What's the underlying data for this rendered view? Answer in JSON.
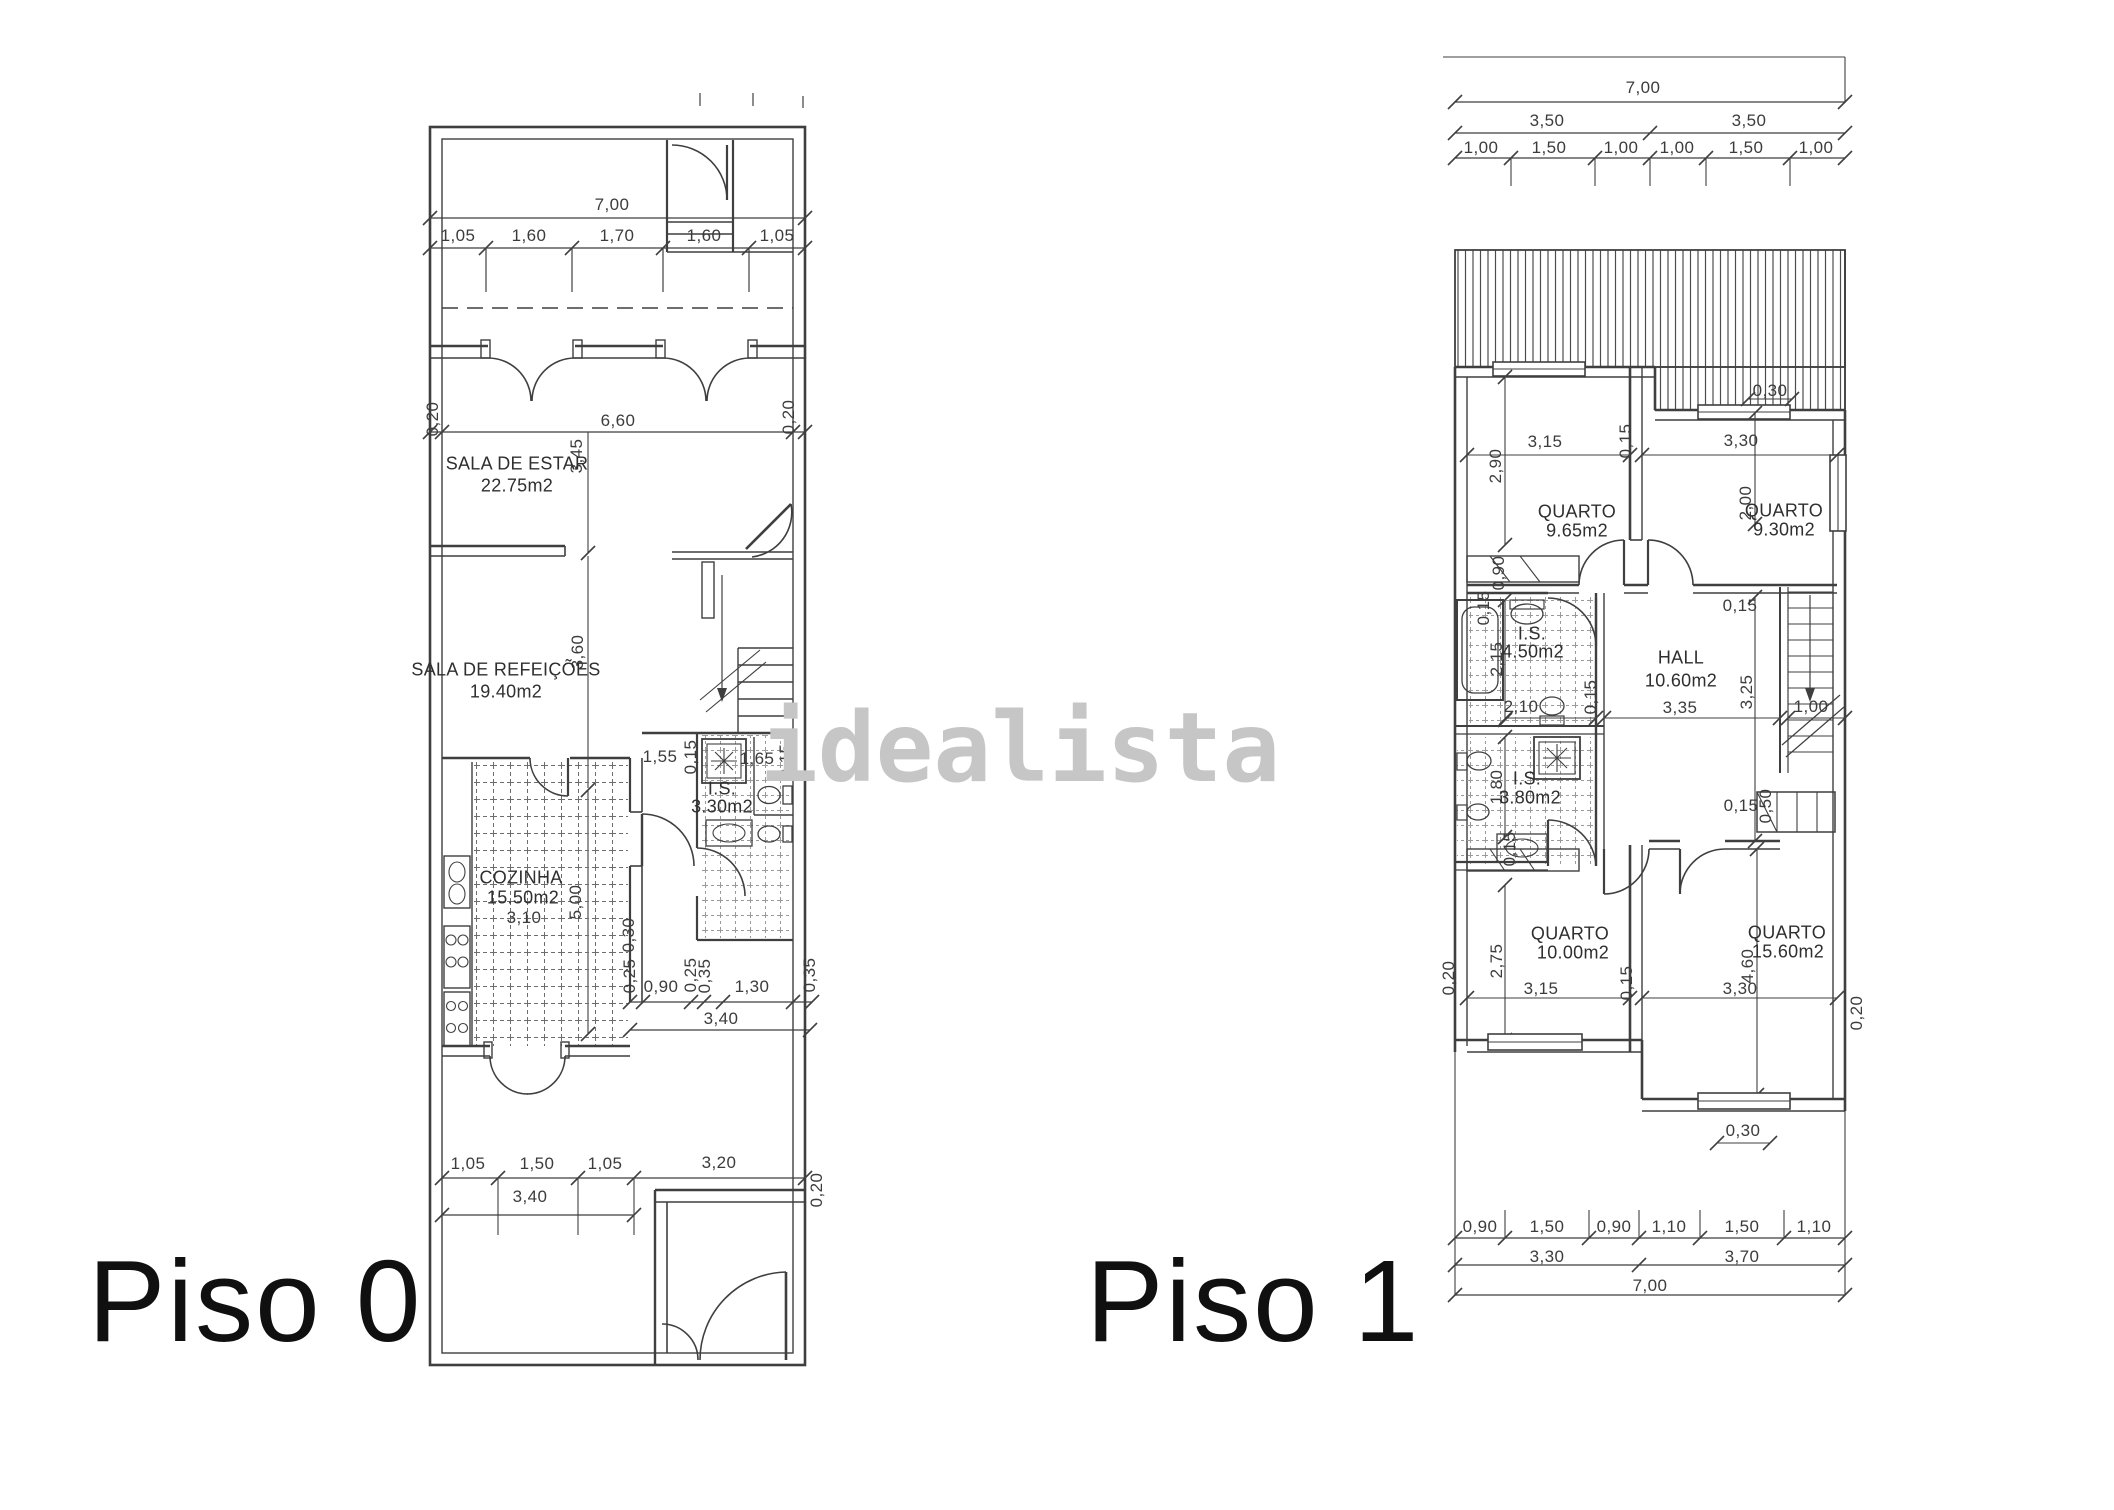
{
  "watermark": "idealista",
  "piso0": {
    "title": "Piso 0",
    "rooms": [
      {
        "name": "SALA DE ESTAR",
        "area": "22.75m2"
      },
      {
        "name": "SALA DE REFEIÇÕES",
        "area": "19.40m2"
      },
      {
        "name": "COZINHA",
        "area": "15.50m2"
      },
      {
        "name": "I.S.",
        "area": "3.30m2"
      }
    ],
    "dims": [
      "7,00",
      "1,05",
      "1,60",
      "1,70",
      "1,60",
      "1,05",
      "0,20",
      "6,60",
      "0,20",
      "3,45",
      "3,60",
      "1,55",
      "0,15",
      "1,65",
      "0,15",
      "5,00",
      "0,30",
      "3,10",
      "0,25",
      "0,90",
      "0,25",
      "0,35",
      "1,30",
      "0,35",
      "3,40",
      "1,05",
      "1,50",
      "1,05",
      "3,20",
      "3,40",
      "0,20"
    ]
  },
  "piso1": {
    "title": "Piso 1",
    "rooms": [
      {
        "name": "QUARTO",
        "area": "9.65m2"
      },
      {
        "name": "QUARTO",
        "area": "9.30m2"
      },
      {
        "name": "I.S.",
        "area": "4.50m2"
      },
      {
        "name": "HALL",
        "area": "10.60m2"
      },
      {
        "name": "I.S.",
        "area": "3.80m2"
      },
      {
        "name": "QUARTO",
        "area": "10.00m2"
      },
      {
        "name": "QUARTO",
        "area": "15.60m2"
      }
    ],
    "dims": [
      "7,00",
      "3,50",
      "3,50",
      "1,00",
      "1,50",
      "1,00",
      "1,00",
      "1,50",
      "1,00",
      "0,30",
      "3,15",
      "0,15",
      "3,30",
      "2,90",
      "2,00",
      "0,90",
      "0,15",
      "2,15",
      "2,10",
      "0,15",
      "0,15",
      "3,25",
      "3,35",
      "1,00",
      "1,80",
      "0,15",
      "0,15",
      "0,50",
      "0,20",
      "2,75",
      "3,15",
      "0,15",
      "4,60",
      "3,30",
      "0,20",
      "0,30",
      "0,90",
      "1,50",
      "0,90",
      "1,10",
      "1,50",
      "1,10",
      "3,30",
      "3,70",
      "7,00"
    ]
  }
}
